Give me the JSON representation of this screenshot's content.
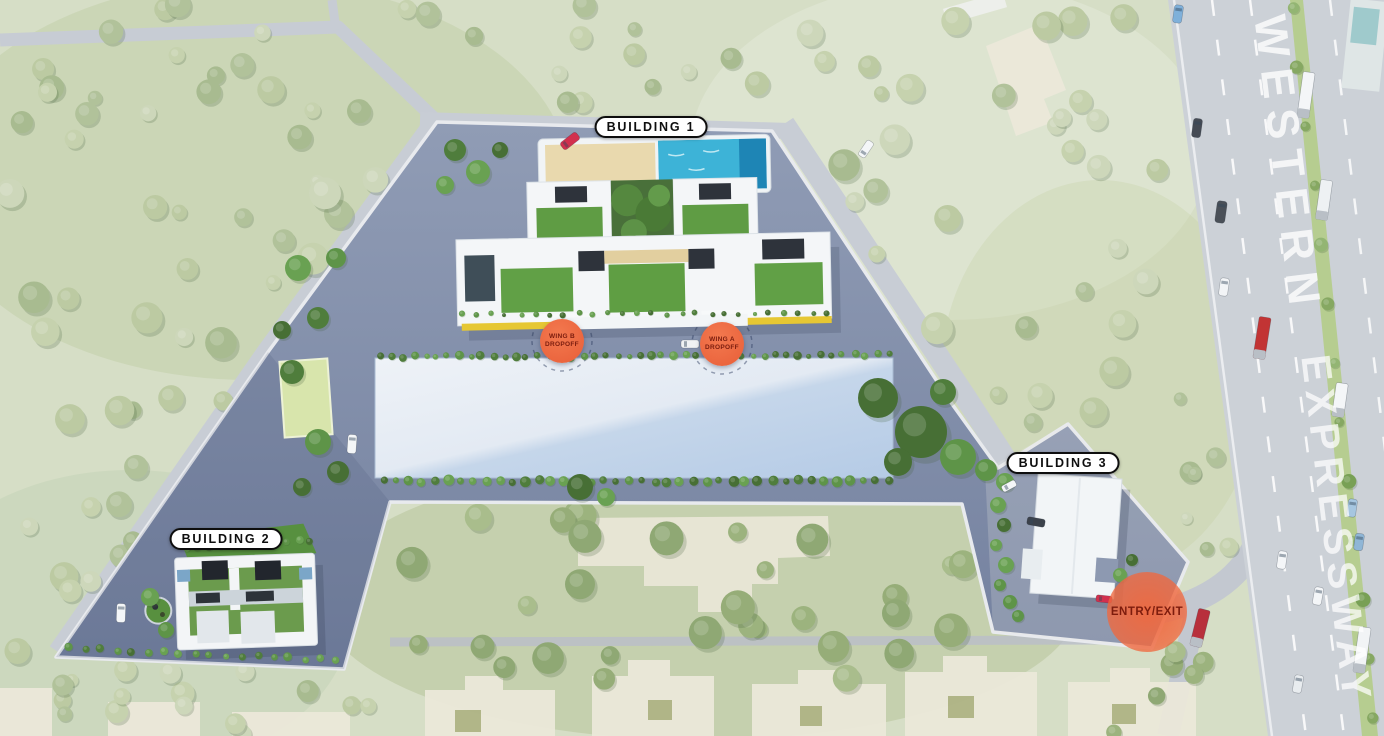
{
  "labels": {
    "building1": "BUILDING 1",
    "building2": "BUILDING 2",
    "building3": "BUILDING 3"
  },
  "markers": {
    "wing_b": {
      "line1": "WING B",
      "line2": "DROPOFF"
    },
    "wing_a": {
      "line1": "WING A",
      "line2": "DROPOFF"
    },
    "entry_exit": "ENTRY/EXIT"
  },
  "expressway": {
    "line1": "WESTERN",
    "line2": "EXPRESSWAY"
  },
  "colors": {
    "marker_orange": "#ed6a45",
    "marker_text": "#7a1c0e",
    "site_asphalt": "#8794af",
    "podium_light": "#edf1f6",
    "podium_blue": "#b7cce6",
    "pool_teal": "#3db3d7",
    "lawn_green": "#5f9c44",
    "grass_washed": "#d6dec6",
    "road_gray": "#ccd1d7",
    "label_ink": "#0e0e0e",
    "expressway_text": "#ffffff"
  }
}
